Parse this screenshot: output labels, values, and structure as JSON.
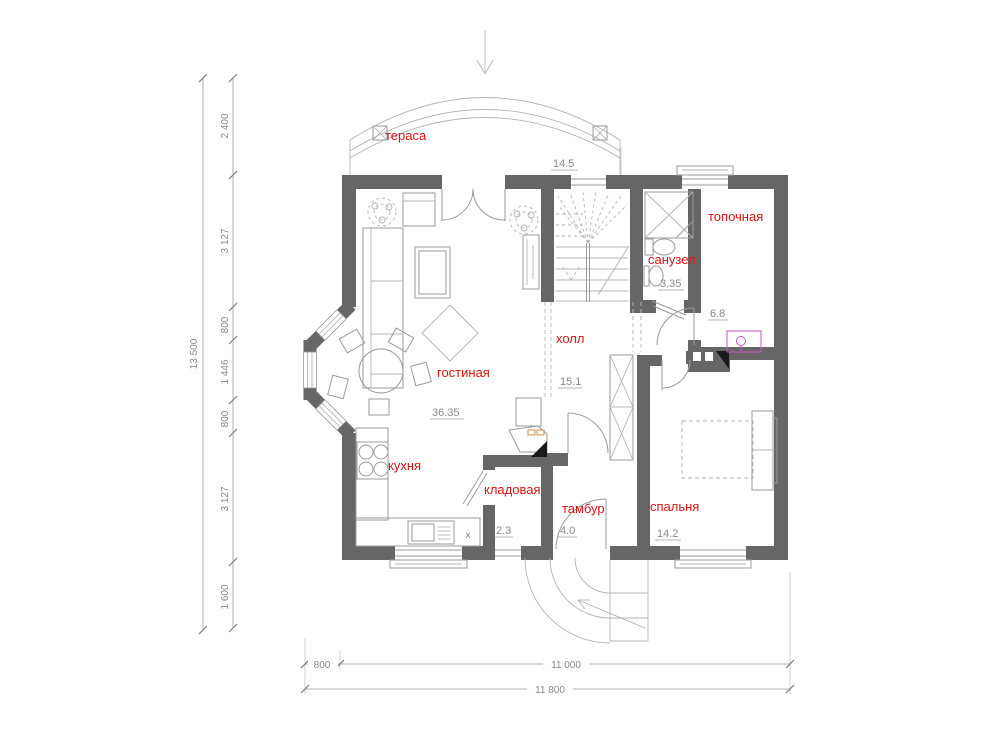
{
  "plan_title": "floor-plan-first-floor",
  "colors": {
    "wall": "#666666",
    "room_label": "#e01212",
    "dimension_text": "#8a8a8a",
    "thin_line": "#9b9b9b",
    "boiler_symbol": "#c455c4"
  },
  "rooms": {
    "terrace": {
      "label": "тераса",
      "area": "14.5"
    },
    "boiler_room": {
      "label": "топочная",
      "area": "6.8"
    },
    "bathroom": {
      "label": "санузел",
      "area": "3.35"
    },
    "hall": {
      "label": "холл",
      "area": "15.1"
    },
    "living_room": {
      "label": "гостиная",
      "area": "36.35"
    },
    "kitchen": {
      "label": "кухня"
    },
    "pantry": {
      "label": "кладовая",
      "area": "2.3"
    },
    "vestibule": {
      "label": "тамбур",
      "area": "4.0"
    },
    "bedroom": {
      "label": "спальня",
      "area": "14.2"
    }
  },
  "dimensions": {
    "left_total": "13 500",
    "left_chain": [
      "2 400",
      "3 127",
      "800",
      "1 446",
      "800",
      "3 127",
      "1 600"
    ],
    "bottom_segments": [
      "800",
      "11 000"
    ],
    "bottom_total": "11 800"
  },
  "marks": {
    "kitchen_x": "x"
  }
}
